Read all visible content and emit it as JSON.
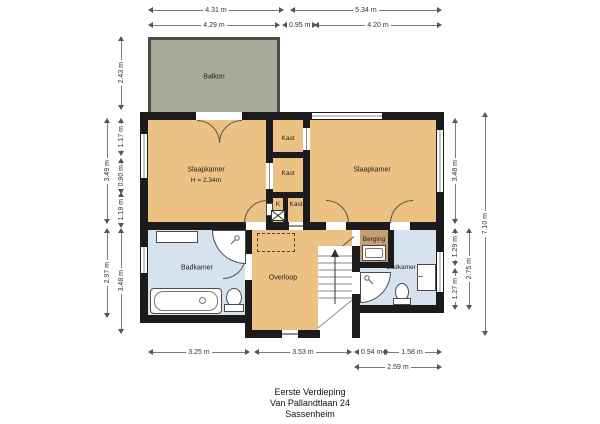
{
  "title_block": {
    "floor": "Eerste Verdieping",
    "address": "Van Pallandtlaan 24",
    "city": "Sassenheim"
  },
  "rooms": {
    "balkon": {
      "label": "Balkon"
    },
    "slaapkamer_left": {
      "label": "Slaapkamer",
      "height": "H = 2.34m"
    },
    "slaapkamer_right": {
      "label": "Slaapkamer"
    },
    "kast_top": {
      "label": "Kast"
    },
    "kast_mid": {
      "label": "Kast"
    },
    "kast_k": {
      "label": "K"
    },
    "kast_bottom": {
      "label": "Kast"
    },
    "badkamer_left": {
      "label": "Badkamer"
    },
    "overloop": {
      "label": "Overloop"
    },
    "berging": {
      "label": "Berging"
    },
    "badkamer_right": {
      "label": "Badkamer"
    }
  },
  "dimensions": {
    "top_row1_left": "4.31 m",
    "top_row1_right": "5.34 m",
    "top_row2_left": "4.29 m",
    "top_row2_mid": "0.95 m",
    "top_row2_right": "4.20 m",
    "bottom_row1_a": "3.25 m",
    "bottom_row1_b": "3.53 m",
    "bottom_row1_c": "0.94 m",
    "bottom_row1_d": "1.58 m",
    "bottom_row2": "2.59 m",
    "left_outer_top": "3.49 m",
    "left_outer_bottom": "2.97 m",
    "left_inner_balcony": "2.43 m",
    "left_inner_a": "1.17 m",
    "left_inner_b": "0.90 m",
    "left_inner_c": "1.19 m",
    "left_inner_d": "3.48 m",
    "right_inner_top": "3.48 m",
    "right_inner_mid": "1.29 m",
    "right_inner_bottom": "1.27 m",
    "right_mid": "2.75 m",
    "right_outer": "7.10 m"
  },
  "colors": {
    "wall": "#1b1b1b",
    "room_orange": "#ebc283",
    "room_blue": "#d6e3ef",
    "balcony_green": "#a8aa9a",
    "berging_brown": "#c79f70"
  }
}
